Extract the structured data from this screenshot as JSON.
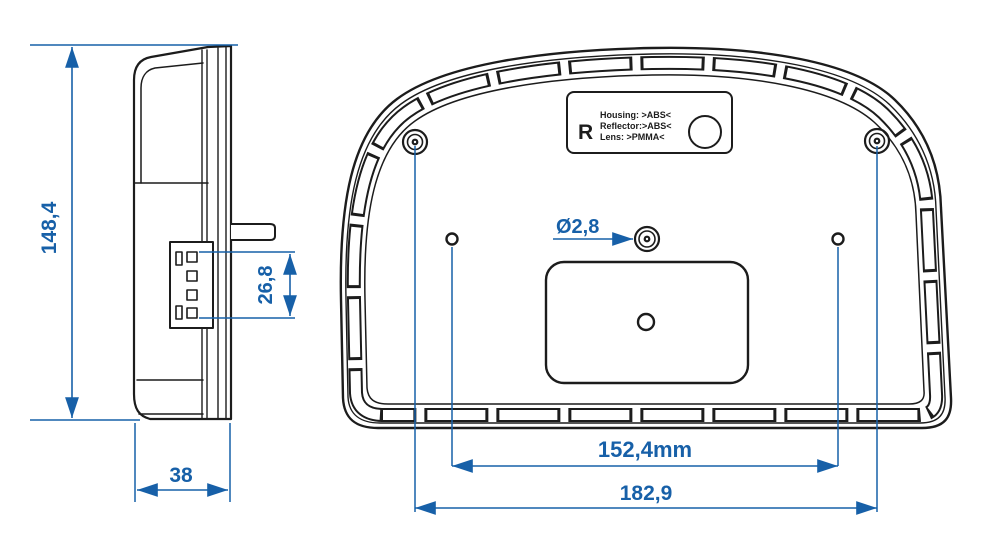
{
  "drawing": {
    "colors": {
      "line": "#1c1c1c",
      "dimension": "#1760a8",
      "background": "#ffffff"
    },
    "side_view": {
      "height_label": "148,4",
      "connector_height_label": "26,8",
      "depth_label": "38"
    },
    "back_view": {
      "hole_diameter_label": "Ø2,8",
      "inner_spacing_label": "152,4mm",
      "outer_spacing_label": "182,9",
      "marking_plate": {
        "symbol": "R",
        "line1": "Housing: >ABS<",
        "line2": "Reflector:>ABS<",
        "line3": "Lens: >PMMA<"
      }
    }
  }
}
